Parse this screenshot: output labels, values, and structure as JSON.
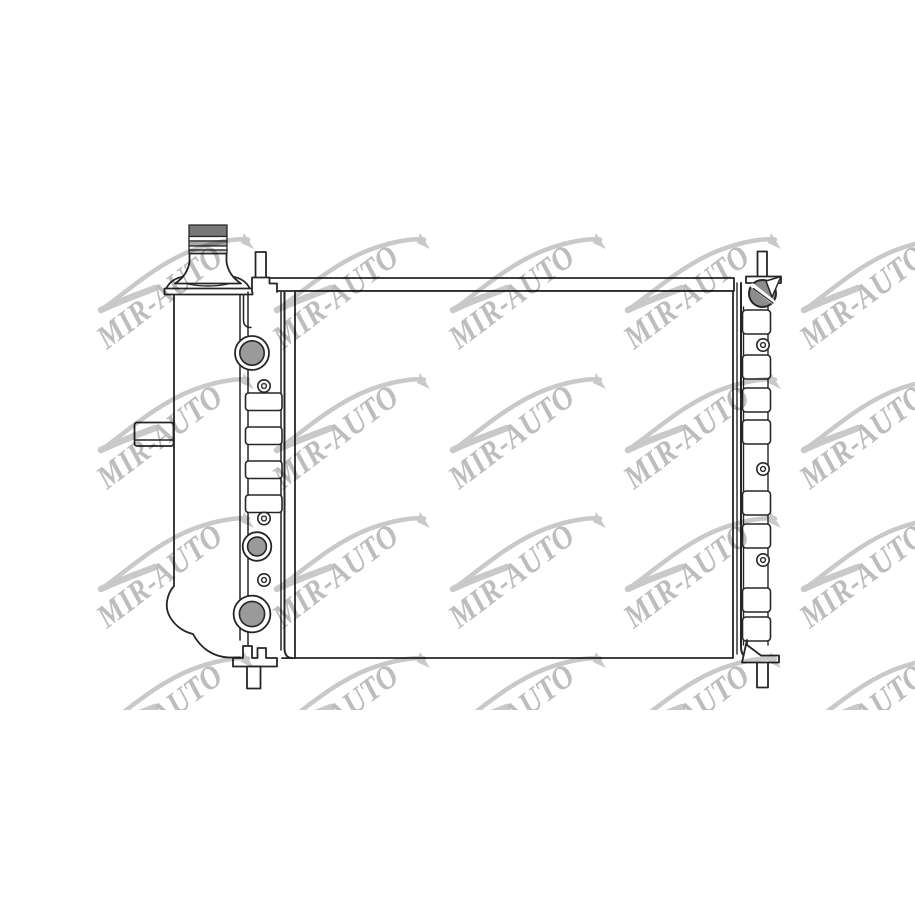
{
  "image": {
    "subject": "Car radiator technical line drawing, front view",
    "background_color": "#ffffff",
    "stroke_color": "#262626"
  },
  "watermark": {
    "text": "MIR-AUTO",
    "text_color": "#bdbdbd",
    "swoosh_color": "#c9c9c9",
    "rotation_deg": -37,
    "grid": {
      "origin_x": 95,
      "origin_y": 230,
      "tile_w": 175.75,
      "tile_h": 139.5,
      "cols": 5,
      "rows": 4,
      "clip_w": 820,
      "clip_h": 480
    }
  },
  "drawing": {
    "port_fill": "#9a9a9a",
    "radiator_cap_fill": "#8d8d8d",
    "filler_cap_dark": "#787878",
    "filler_cap_mid": "#a8a8a8",
    "filler_cap_light": "#c4c4c4",
    "left_ladder": {
      "segment_tops": [
        393,
        427,
        461,
        495
      ],
      "segment_x": 245.5,
      "segment_w": 36.5,
      "segment_h": 17.5,
      "ports": [
        {
          "cx": 252,
          "cy": 353,
          "r_outer": 17,
          "r_inner": 12.2
        },
        {
          "cx": 257,
          "cy": 546.5,
          "r_outer": 14.3,
          "r_inner": 9.4
        },
        {
          "cx": 252,
          "cy": 614,
          "r_outer": 18.4,
          "r_inner": 12.6
        }
      ],
      "small_rings": [
        {
          "cx": 264,
          "cy": 386
        },
        {
          "cx": 264,
          "cy": 518.5
        },
        {
          "cx": 264,
          "cy": 580
        }
      ]
    },
    "right_ladder": {
      "segment_tops": [
        310,
        355,
        388,
        420,
        491,
        524,
        588,
        617
      ],
      "segment_x": 742.5,
      "segment_w": 28,
      "segment_h": 24,
      "small_rings": [
        {
          "cx": 763,
          "cy": 345
        },
        {
          "cx": 763,
          "cy": 469
        },
        {
          "cx": 763,
          "cy": 560
        }
      ]
    }
  }
}
